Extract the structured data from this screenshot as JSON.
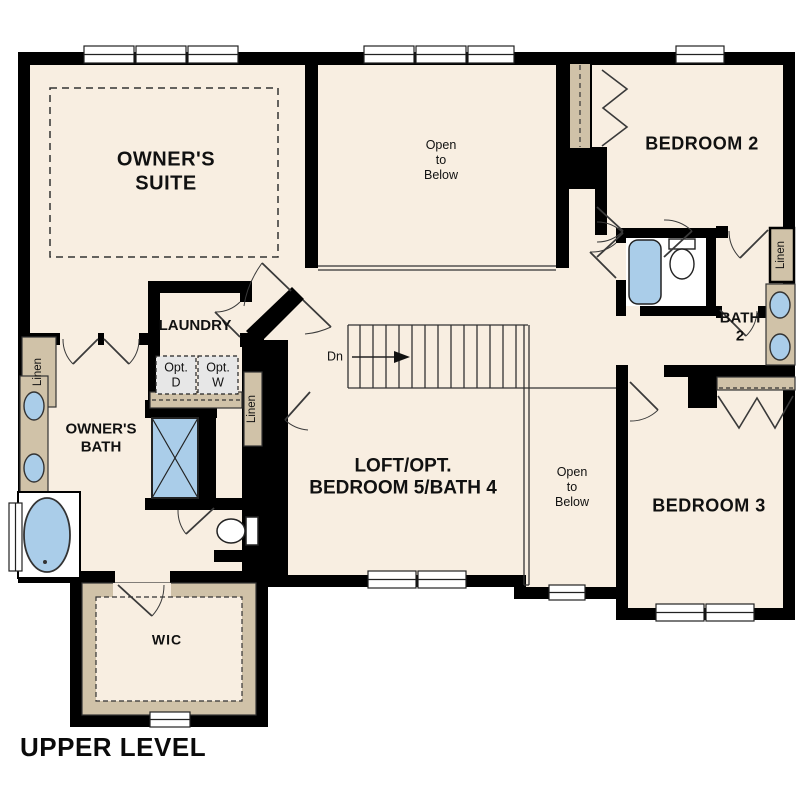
{
  "plan": {
    "title": "UPPER LEVEL",
    "rooms": {
      "owners_suite": [
        "OWNER'S",
        "SUITE"
      ],
      "open_to_below_top": [
        "Open",
        "to",
        "Below"
      ],
      "bedroom_2": "BEDROOM 2",
      "bath_2": [
        "BATH",
        "2"
      ],
      "bedroom_3": "BEDROOM 3",
      "open_to_below_small": [
        "Open",
        "to",
        "Below"
      ],
      "loft": [
        "LOFT/OPT.",
        "BEDROOM 5/BATH 4"
      ],
      "laundry": "LAUNDRY",
      "owners_bath": [
        "OWNER'S",
        "BATH"
      ],
      "wic": "WIC"
    },
    "closets": {
      "linen_left": "Linen",
      "linen_mid": "Linen",
      "linen_right": "Linen"
    },
    "appliances": {
      "opt_dryer": [
        "Opt.",
        "D"
      ],
      "opt_washer": [
        "Opt.",
        "W"
      ]
    },
    "stairs": {
      "down_label": "Dn"
    },
    "colors": {
      "floor": "#f8eee1",
      "wall": "#000000",
      "casework_tan": "#d0c2a8",
      "fixture_blue": "#aacde9",
      "appliance_gray": "#e7e7e7",
      "outside": "#ffffff"
    }
  }
}
